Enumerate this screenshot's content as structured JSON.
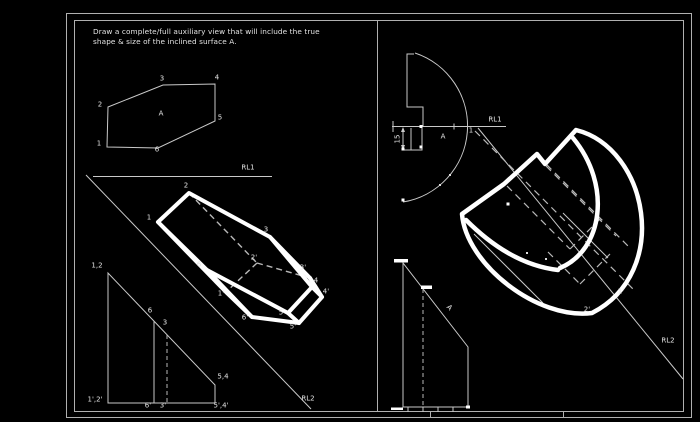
{
  "title": "auxiliary-view-exercise",
  "instruction": {
    "line1": "Draw a complete/full auxiliary view that will include the true",
    "line2": "shape & size of the inclined surface A."
  },
  "colors": {
    "background": "#000000",
    "thin_line": "#c9c9c9",
    "thick_line": "#ffffff",
    "frame_line": "#b0b0b0",
    "text": "#e4e4e4"
  },
  "left_panel": {
    "reference_lines": [
      {
        "t": "RL1",
        "x": 248,
        "y": 168,
        "n": "rl1-label-left"
      },
      {
        "t": "RL2",
        "x": 308,
        "y": 399,
        "n": "rl2-label-left"
      }
    ],
    "top_view_labels": [
      {
        "t": "2",
        "x": 100,
        "y": 105
      },
      {
        "t": "3",
        "x": 162,
        "y": 79
      },
      {
        "t": "4",
        "x": 217,
        "y": 78
      },
      {
        "t": "5",
        "x": 220,
        "y": 118
      },
      {
        "t": "6",
        "x": 157,
        "y": 150
      },
      {
        "t": "1",
        "x": 99,
        "y": 144
      },
      {
        "t": "A",
        "x": 161,
        "y": 114,
        "n": "surface-a-label"
      }
    ],
    "auxiliary_view_labels": [
      {
        "t": "2",
        "x": 186,
        "y": 186
      },
      {
        "t": "1",
        "x": 149,
        "y": 218
      },
      {
        "t": "3",
        "x": 266,
        "y": 230
      },
      {
        "t": "6",
        "x": 199,
        "y": 265
      },
      {
        "t": "4",
        "x": 316,
        "y": 281
      },
      {
        "t": "4'",
        "x": 326,
        "y": 292
      },
      {
        "t": "3'",
        "x": 303,
        "y": 268
      },
      {
        "t": "2'",
        "x": 254,
        "y": 258
      },
      {
        "t": "1'",
        "x": 221,
        "y": 294
      },
      {
        "t": "6'",
        "x": 245,
        "y": 318
      },
      {
        "t": "5",
        "x": 281,
        "y": 313
      },
      {
        "t": "5'",
        "x": 293,
        "y": 327
      }
    ],
    "profile_view_labels": [
      {
        "t": "1,2",
        "x": 97,
        "y": 266
      },
      {
        "t": "6",
        "x": 150,
        "y": 311
      },
      {
        "t": "3",
        "x": 165,
        "y": 323
      },
      {
        "t": "5,4",
        "x": 223,
        "y": 377
      },
      {
        "t": "1',2'",
        "x": 95,
        "y": 400
      },
      {
        "t": "6'",
        "x": 148,
        "y": 406
      },
      {
        "t": "3'",
        "x": 163,
        "y": 406
      },
      {
        "t": "5',4'",
        "x": 221,
        "y": 406
      }
    ]
  },
  "right_panel": {
    "reference_lines": [
      {
        "t": "RL1",
        "x": 495,
        "y": 120,
        "n": "rl1-label-right"
      },
      {
        "t": "RL2",
        "x": 668,
        "y": 341,
        "n": "rl2-label-right"
      }
    ],
    "plan_view_labels": [
      {
        "t": "1",
        "x": 471,
        "y": 131
      },
      {
        "t": "A",
        "x": 443,
        "y": 137,
        "n": "surface-a-label"
      },
      {
        "t": "15",
        "x": 398,
        "y": 139,
        "rot": -90,
        "n": "dimension-15-label"
      }
    ],
    "auxiliary_view_labels": [
      {
        "t": "1'",
        "x": 621,
        "y": 292
      },
      {
        "t": "2'",
        "x": 587,
        "y": 310
      }
    ],
    "front_view_labels": [
      {
        "t": "A",
        "x": 449,
        "y": 308,
        "rot": 45,
        "n": "surface-a-label"
      }
    ]
  }
}
